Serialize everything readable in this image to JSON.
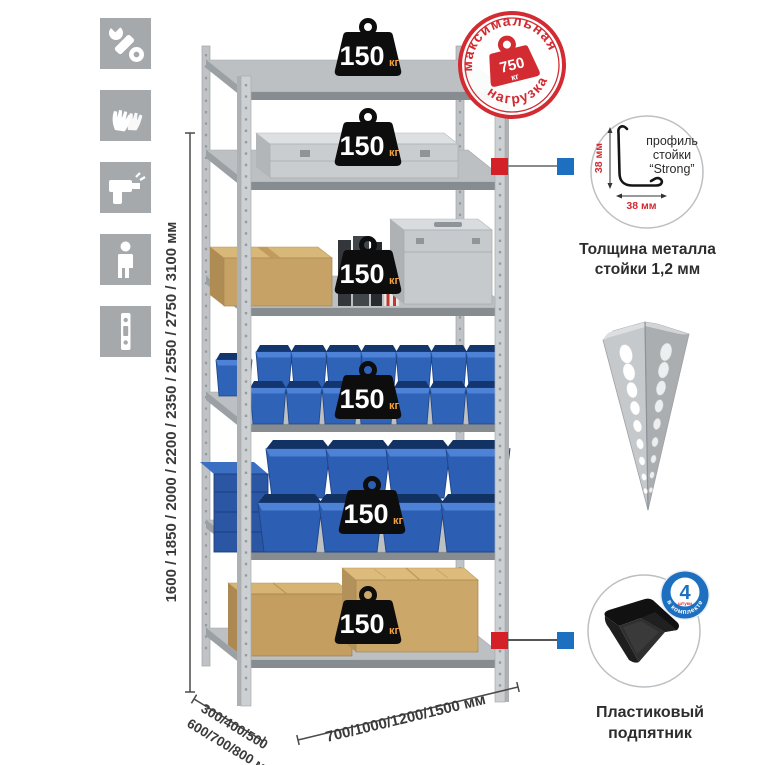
{
  "sidebar": {
    "icons": [
      "wrench",
      "gloves",
      "drill",
      "person",
      "profile-strip"
    ]
  },
  "dimensions": {
    "height": "1600 / 1850 / 2000 / 2200 / 2350 / 2550 / 2750 / 3100 мм",
    "depth_line1": "300/400/500",
    "depth_line2": "600/700/800 мм",
    "width": "700/1000/1200/1500 мм"
  },
  "shelf_badges": [
    {
      "value": "150",
      "unit": "кг"
    },
    {
      "value": "150",
      "unit": "кг"
    },
    {
      "value": "150",
      "unit": "кг"
    },
    {
      "value": "150",
      "unit": "кг"
    },
    {
      "value": "150",
      "unit": "кг"
    },
    {
      "value": "150",
      "unit": "кг"
    }
  ],
  "stamp": {
    "arc_top": "максимальная",
    "arc_bottom": "нагрузка",
    "weight_value": "750",
    "weight_unit": "кг"
  },
  "profile_callout": {
    "line1": "профиль",
    "line2": "стойки",
    "line3": "“Strong”",
    "dim_vertical": "38 мм",
    "dim_horizontal": "38 мм",
    "caption_line1": "Толщина металла",
    "caption_line2": "стойки 1,2 мм"
  },
  "foot_callout": {
    "badge_value": "4",
    "badge_small": "штуки",
    "badge_arc": "в комплекте",
    "caption_line1": "Пластиковый",
    "caption_line2": "подпятник"
  },
  "colors": {
    "accent_red": "#d22b31",
    "accent_blue": "#1d6fc0",
    "bin_blue": "#2f63b8",
    "steel_gray": "#c6c9cc",
    "icon_gray": "#a5a9ac",
    "badge_black": "#0d0d0d",
    "badge_unit_orange": "#f5a13d"
  }
}
